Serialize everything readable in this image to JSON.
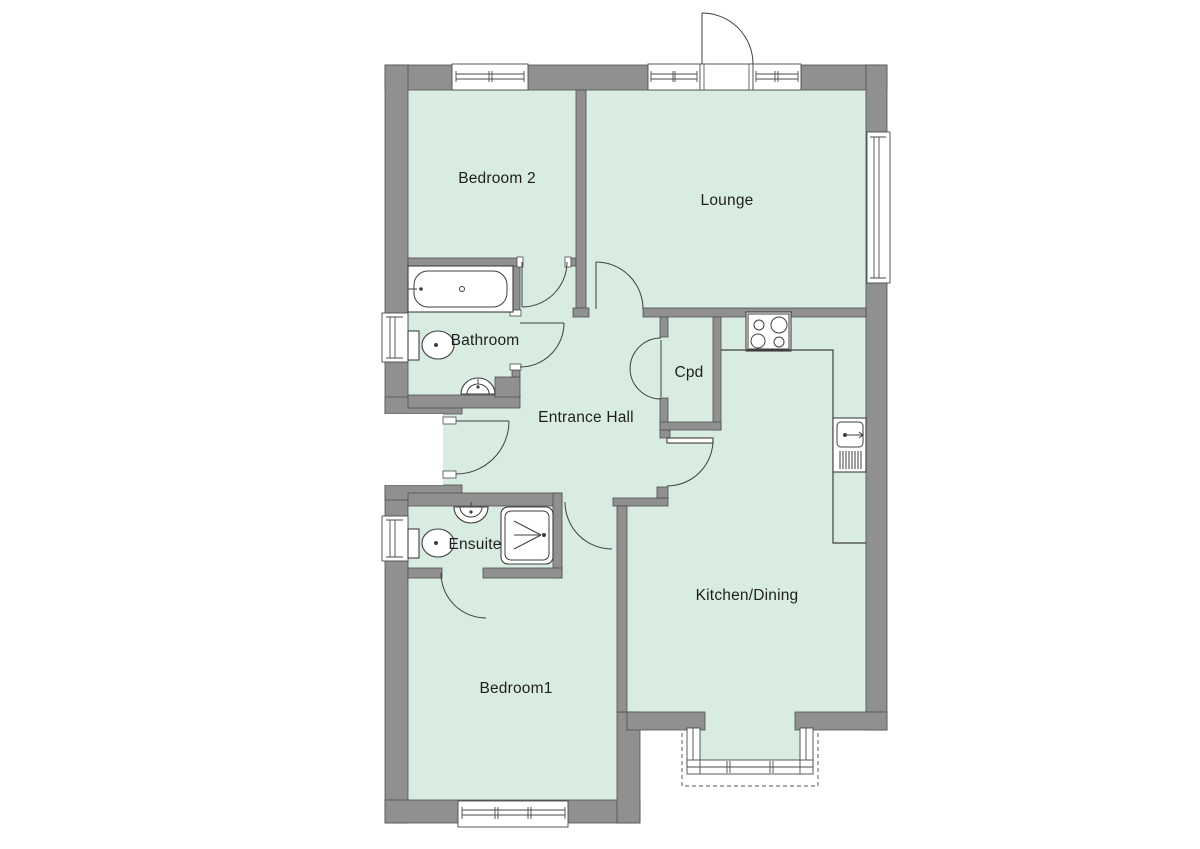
{
  "plan": {
    "title": "Bungalow floor plan",
    "rooms": [
      {
        "id": "bedroom-2",
        "label": "Bedroom 2"
      },
      {
        "id": "lounge",
        "label": "Lounge"
      },
      {
        "id": "bathroom",
        "label": "Bathroom"
      },
      {
        "id": "entrance-hall",
        "label": "Entrance Hall"
      },
      {
        "id": "cpd",
        "label": "Cpd"
      },
      {
        "id": "ensuite",
        "label": "Ensuite"
      },
      {
        "id": "bedroom-1",
        "label": "Bedroom1"
      },
      {
        "id": "kitchen-dining",
        "label": "Kitchen/Dining"
      }
    ],
    "fixtures": [
      "bathtub",
      "toilet",
      "wash-basin",
      "shower",
      "hob",
      "kitchen-sink",
      "drainer",
      "worktop",
      "bay-window"
    ],
    "colors": {
      "wall": "#909090",
      "wall_outline": "#4f4f4f",
      "floor": "#d8ece1",
      "fixture_line": "#3f3f3f",
      "background": "#ffffff",
      "label_text": "#1f1f1f"
    }
  }
}
